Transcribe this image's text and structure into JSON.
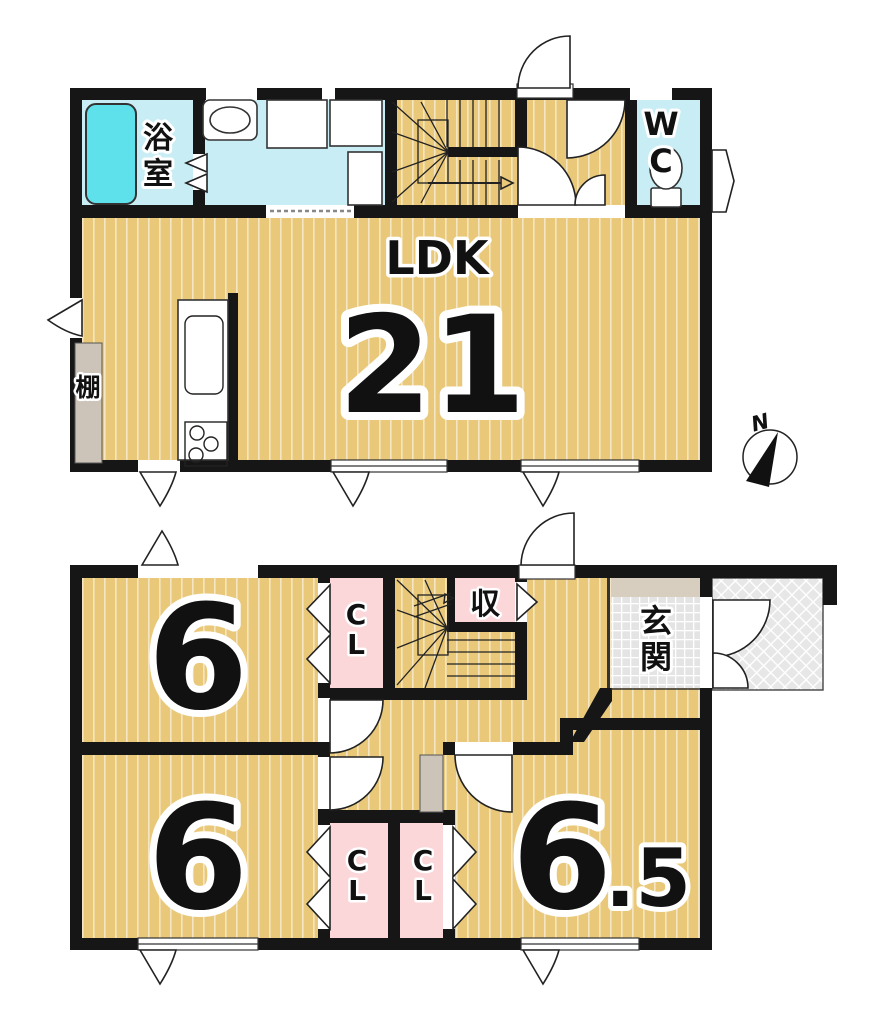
{
  "plan": {
    "upper": {
      "bath1": "浴",
      "bath2": "室",
      "wc1": "W",
      "wc2": "C",
      "ldk": "LDK",
      "ldk_size": "21",
      "shelf": "棚"
    },
    "lower": {
      "storage": "収",
      "entrance1": "玄",
      "entrance2": "関",
      "room_a": "6",
      "room_b": "6",
      "room_c_whole": "6",
      "room_c_frac": ".5",
      "closet_top_1": "C",
      "closet_top_2": "L",
      "closet_b1_1": "C",
      "closet_b1_2": "L",
      "closet_b2_1": "C",
      "closet_b2_2": "L"
    },
    "compass_n": "N"
  }
}
